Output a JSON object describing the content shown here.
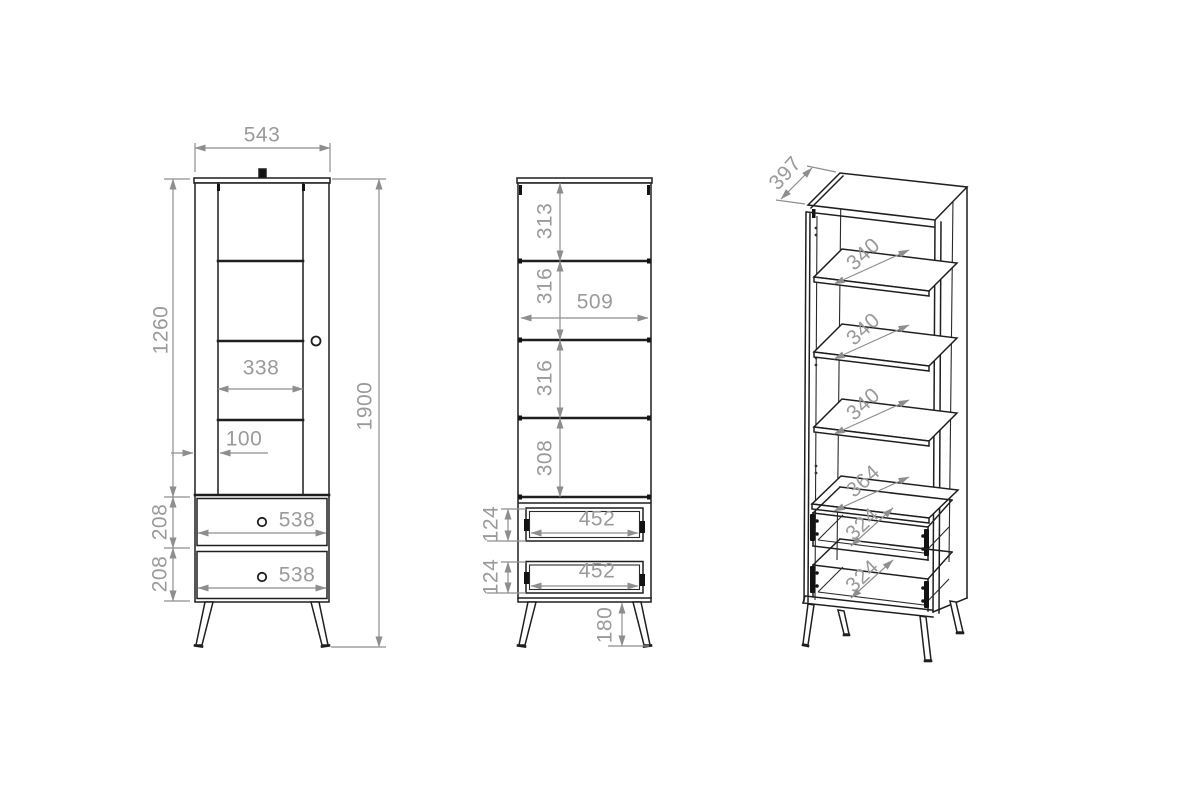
{
  "drawing": {
    "type": "furniture-technical-drawing",
    "units": "mm",
    "colors": {
      "outline": "#1f1f1f",
      "dimension_lines": "#8e8e8e",
      "dimension_text": "#9a9a9a",
      "background": "#ffffff"
    },
    "front_view": {
      "overall_width": "543",
      "overall_height": "1900",
      "door_height": "1260",
      "glass_width": "338",
      "glass_offset": "100",
      "drawer_front_heights": [
        "208",
        "208"
      ],
      "drawer_front_widths": [
        "538",
        "538"
      ]
    },
    "inside_view": {
      "compartment_heights": [
        "313",
        "316",
        "316",
        "308"
      ],
      "interior_width": "509",
      "drawer_box_heights": [
        "124",
        "124"
      ],
      "drawer_box_widths": [
        "452",
        "452"
      ],
      "leg_height": "180"
    },
    "perspective_view": {
      "overall_depth": "397",
      "shelf_depths": [
        "340",
        "340",
        "340"
      ],
      "bottom_shelf_depth": "364",
      "drawer_depths": [
        "324",
        "324"
      ]
    }
  }
}
